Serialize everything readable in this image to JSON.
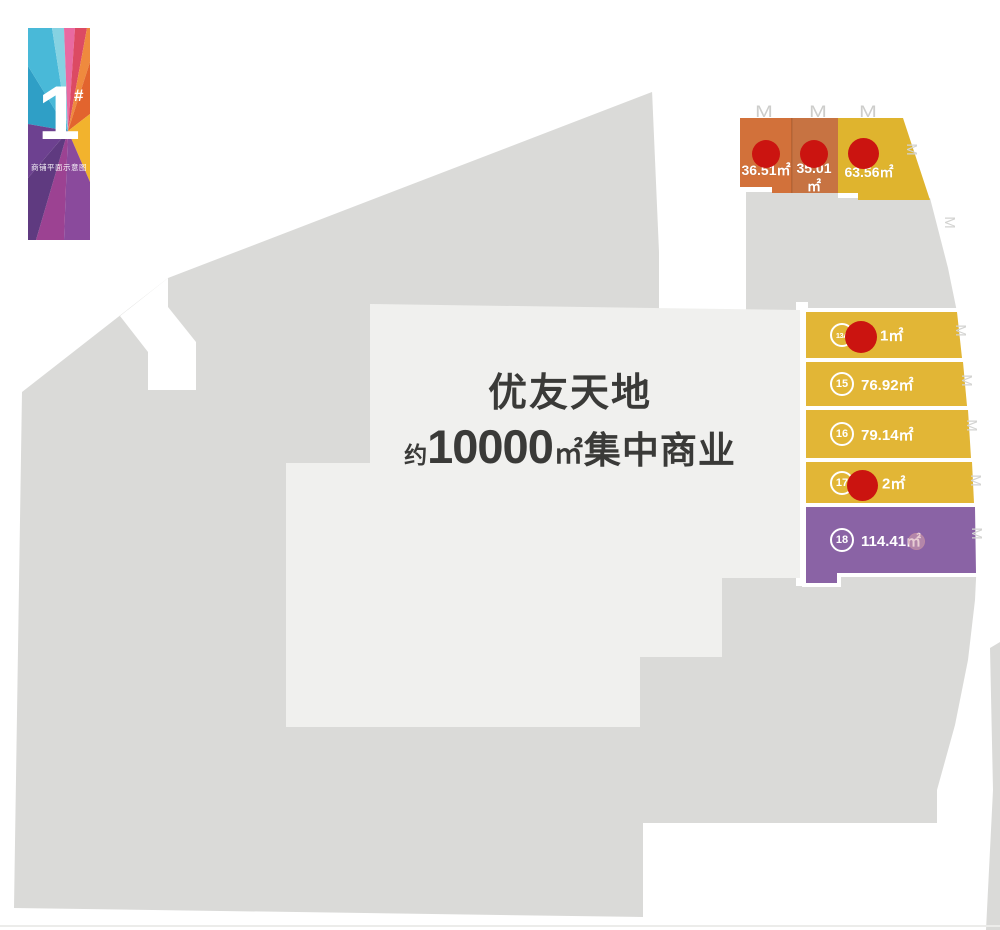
{
  "badge": {
    "number": "1",
    "hash": "#",
    "caption": "商铺平面示意图"
  },
  "building": {
    "name": "优友天地",
    "desc_prefix": "约",
    "desc_number": "10000",
    "desc_unit": "㎡",
    "desc_suffix": "集中商业"
  },
  "top_units": [
    {
      "area": "36.51㎡",
      "status": "sold"
    },
    {
      "area": "35.01㎡",
      "status": "sold"
    },
    {
      "area": "63.56㎡",
      "status": "sold"
    }
  ],
  "side_units": [
    {
      "id": "13A",
      "area": "1㎡",
      "status": "sold"
    },
    {
      "id": "15",
      "area": "76.92㎡",
      "status": "available"
    },
    {
      "id": "16",
      "area": "79.14㎡",
      "status": "available"
    },
    {
      "id": "17",
      "area": "2㎡",
      "status": "sold"
    },
    {
      "id": "18",
      "area": "114.41㎡",
      "status": "available"
    }
  ],
  "icons": {
    "door_glyph": "M",
    "stair_glyph": "M"
  },
  "colors": {
    "site_mass": "#dadad8",
    "building_fill": "#f0f0ee",
    "orange_unit_1": "#d2713a",
    "orange_unit_2": "#c77342",
    "yellow_unit": "#e2b636",
    "yellow_unit_top": "#dfb42e",
    "purple_unit": "#8a63a5",
    "sold_dot": "#cb1410",
    "label_dark": "#3a3a38",
    "page_white": "#ffffff"
  }
}
